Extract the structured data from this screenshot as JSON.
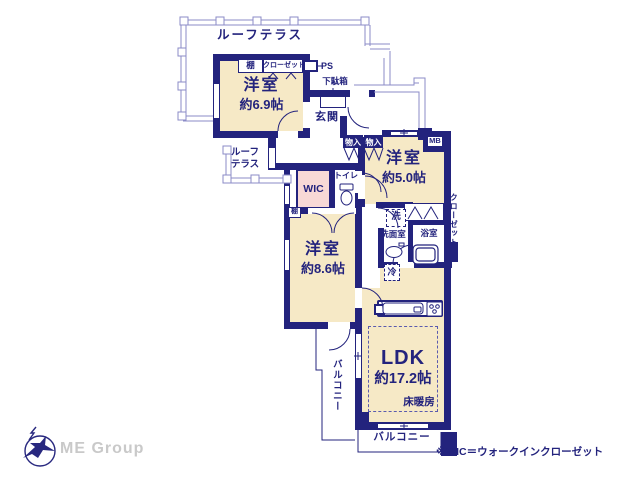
{
  "labels": {
    "roof_terrace": "ルーフテラス",
    "roof_terrace2_l1": "ルーフ",
    "roof_terrace2_l2": "テラス",
    "shelf": "棚",
    "closet": "クローゼット",
    "ps": "PS",
    "shoe_cabinet": "下駄箱",
    "entrance": "玄関",
    "storage_a": "物入",
    "storage_b": "物入",
    "mb": "MB",
    "room1_name": "洋室",
    "room1_size": "約6.9帖",
    "room2_name": "洋室",
    "room2_size": "約5.0帖",
    "room3_name": "洋室",
    "room3_size": "約8.6帖",
    "wic": "WIC",
    "toilet": "トイレ",
    "washer": "洗",
    "washroom": "洗面室",
    "bathroom": "浴室",
    "fridge": "冷",
    "shelf_small": "棚",
    "closet_side": "クローゼット",
    "ldk_name": "LDK",
    "ldk_size": "約17.2帖",
    "floor_heating": "床暖房",
    "balcony_left": "バルコニー",
    "balcony_bottom": "バルコニー",
    "brand": "ME Group",
    "footnote": "※WIC＝ウォークインクローゼット"
  },
  "colors": {
    "wall_navy": "#23237d",
    "room_cream": "#f6e9c6",
    "closet_pink": "#f8d9d6",
    "fence_line": "#8b8bc7",
    "brand_gray": "#c9c9c9"
  }
}
